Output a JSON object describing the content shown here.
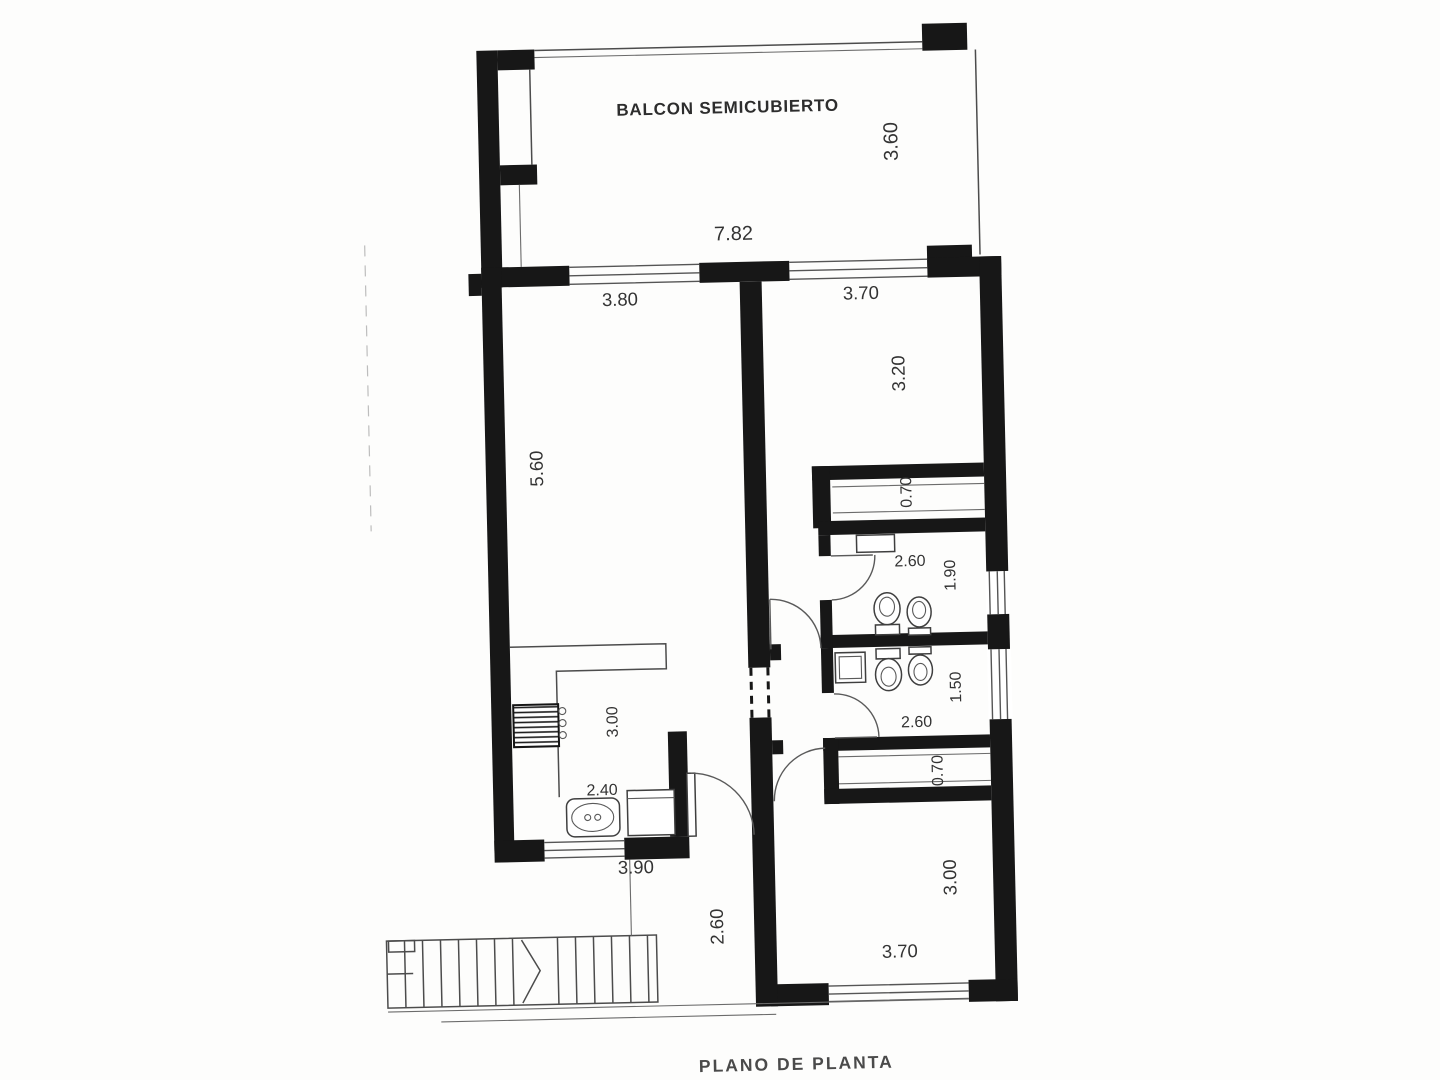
{
  "meta": {
    "title": "PLANO DE PLANTA"
  },
  "rooms": {
    "balcony": {
      "name": "BALCON SEMICUBIERTO",
      "width": "7.82",
      "depth": "3.60"
    },
    "living": {
      "window_width": "3.80",
      "depth": "5.60"
    },
    "kitchen": {
      "width": "2.40",
      "length": "3.00",
      "window_width": "3.90"
    },
    "bedroom_top": {
      "window_width": "3.70",
      "depth": "3.20"
    },
    "closet_top": {
      "depth": "0.70"
    },
    "bathroom_top": {
      "width": "2.60",
      "depth": "1.90"
    },
    "bathroom_bottom": {
      "width": "2.60",
      "depth": "1.50"
    },
    "closet_bottom": {
      "depth": "0.70"
    },
    "bedroom_bottom": {
      "width": "3.70",
      "depth": "3.00"
    },
    "corridor": {
      "width": "2.60"
    }
  },
  "colors": {
    "wall": "#171717",
    "line": "#4c4c4c",
    "text": "#333333",
    "paper": "#fdfdfc"
  }
}
